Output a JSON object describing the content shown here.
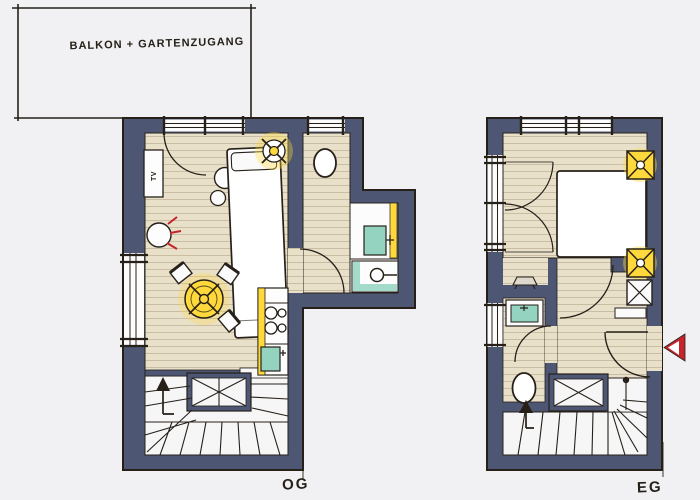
{
  "balcony": {
    "label": "BALKON + GARTENZUGANG"
  },
  "plans": {
    "og": {
      "label": "OG"
    },
    "eg": {
      "label": "EG"
    }
  },
  "furniture_text": {
    "tv": "TV"
  },
  "palette": {
    "background": "#f1f1f3",
    "wall": "#4d5774",
    "ink": "#262019",
    "floor_wood": "#e9e0ca",
    "floor_plank_line": "#bfb296",
    "stair_white": "#f6f6f7",
    "room_white": "#fcfcfd",
    "accent_yellow": "#ffd93b",
    "accent_teal": "#93d3bf",
    "accent_red": "#c5242b"
  },
  "icons": {
    "ceiling_lamp": "circle-with-x-cross-and-yellow-glow",
    "wall_lamp": "yellow-square-with-x-cross",
    "shaft": "white-square-with-x-cross",
    "stove": "four-burner-circles",
    "sink": "teal-basin-with-tap",
    "shower": "circle-with-handle-line",
    "toilet": "white-oval",
    "stairs_up_arrow": "black-triangle-arrow",
    "entrance_arrow": "red-triangle-pointing-left",
    "tv_eg": "flat-trapezoid-on-wall",
    "stair_core": "crossed-box"
  }
}
